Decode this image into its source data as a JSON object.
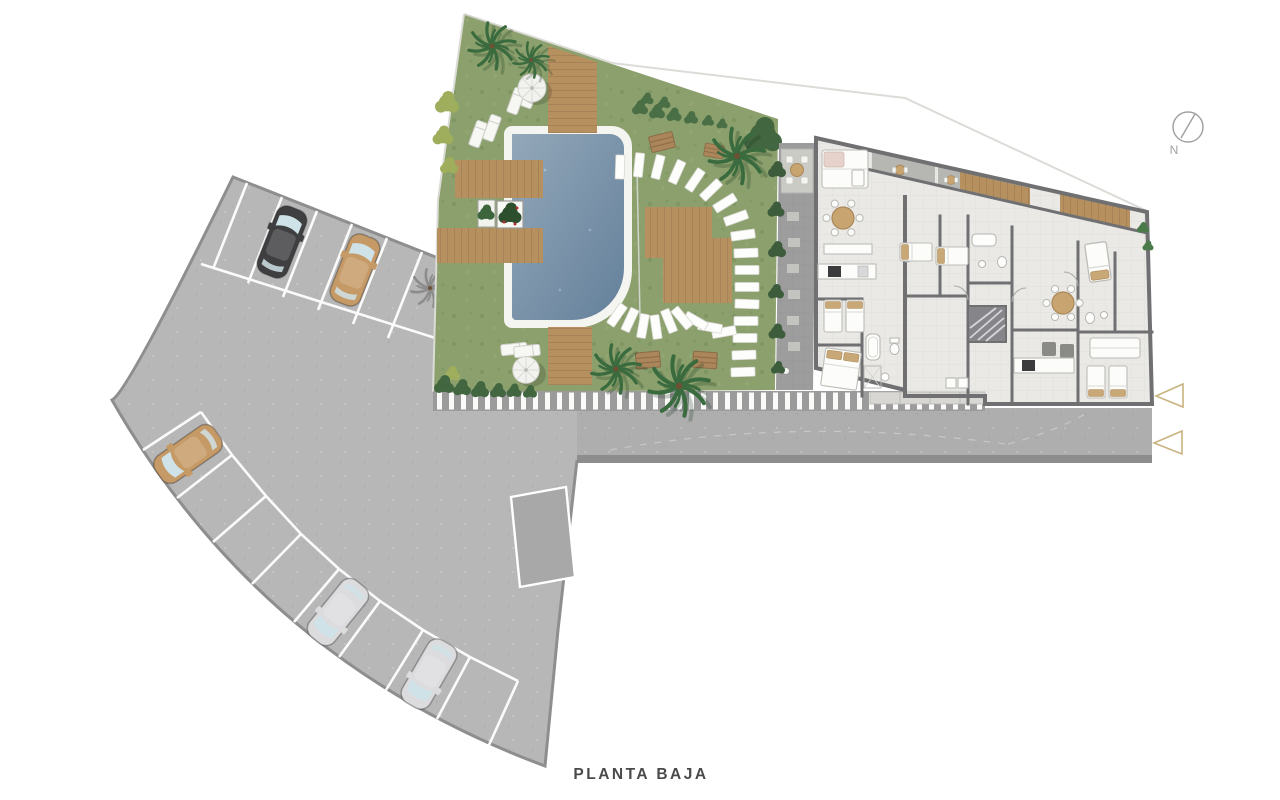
{
  "title": {
    "text": "PLANTA BAJA"
  },
  "compass": {
    "label": "N"
  },
  "markers": {
    "count": 2,
    "shape": "left-pointing-triangle",
    "color": "#c9b480"
  },
  "colors": {
    "background": "#ffffff",
    "pavement": "#b7b7b8",
    "pavement_border": "#8e8e8f",
    "road": "#aeaeaf",
    "curb": "#8d8d8e",
    "parking_line": "#ffffff",
    "grass": "#8ba06c",
    "shrub_dark": "#3f6040",
    "palm_green": "#3a6b3f",
    "pool_light": "#93a8b9",
    "pool_dark": "#64809b",
    "coping": "#f4f4f1",
    "wood": "#b6915f",
    "wood_line": "#96734d",
    "wall": "#707072",
    "floor": "#eae9e6",
    "courtyard": "#9d9d9e",
    "furniture_white": "#fcfcfa",
    "accent_tan": "#c8a470",
    "marker_gold": "#c9b480",
    "title_text": "#4a4a4b",
    "compass_gray": "#a3a3a3"
  },
  "scene": {
    "areas": [
      "parking-lot",
      "garden",
      "swimming-pool",
      "apartment-building",
      "access-road",
      "courtyard"
    ],
    "cars": [
      {
        "name": "car-black",
        "color": "#3f3f41"
      },
      {
        "name": "car-tan-top",
        "color": "#c59a66"
      },
      {
        "name": "car-tan-side",
        "color": "#c59a66"
      },
      {
        "name": "car-silver-upper",
        "color": "#dcdcde"
      },
      {
        "name": "car-silver-lower",
        "color": "#dcdcde"
      }
    ],
    "counts": {
      "cars": 5,
      "parasols": 2,
      "palm_trees": 6,
      "sun_loungers": 6,
      "direction_markers": 2
    }
  }
}
